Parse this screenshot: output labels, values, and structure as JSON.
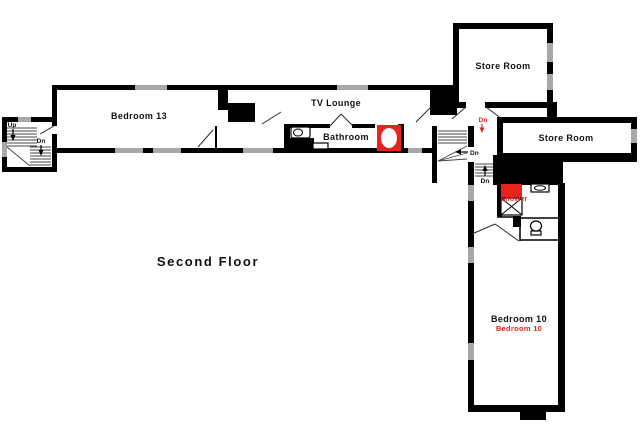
{
  "floor": {
    "title": "Second Floor"
  },
  "rooms": {
    "bedroom13": {
      "label": "Bedroom 13"
    },
    "tv_lounge": {
      "label": "TV Lounge"
    },
    "bathroom": {
      "label": "Bathroom"
    },
    "store_room_top": {
      "label": "Store Room"
    },
    "store_room_right": {
      "label": "Store Room"
    },
    "shower_room": {
      "label": "Shower"
    },
    "bedroom10": {
      "label": "Bedroom 10",
      "label_red": "Bedroom 10"
    }
  },
  "stairs": {
    "left": {
      "up": "Up",
      "down": "Dn"
    },
    "mid": {
      "down": "Dn"
    },
    "lower": {
      "down": "Dn"
    },
    "landing": {
      "down": "Dn"
    }
  },
  "colors": {
    "wall": "#000000",
    "window": "#a8a8a8",
    "accent": "#e8231c",
    "ink": "#111111"
  }
}
